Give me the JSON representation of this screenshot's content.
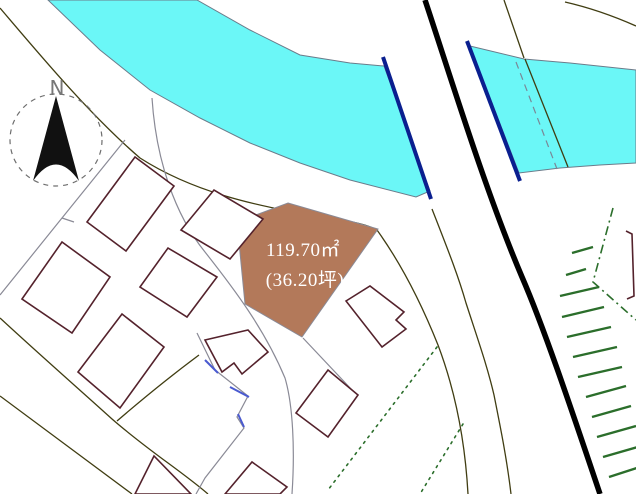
{
  "map": {
    "type": "cadastral-site-map",
    "compass": {
      "label": "N"
    },
    "parcel": {
      "area_label": "119.70㎡",
      "area_sub_label": "(36.20坪)"
    },
    "colors": {
      "river_fill": "#6bf7f7",
      "river_edge": "#6b7b8a",
      "river_inner_dash": "#7a8796",
      "river_bank_accent": "#0a1f8f",
      "parcel_fill": "#b3795a",
      "parcel_text": "#ffffff",
      "building_outline": "#54222c",
      "street_line": "#8a8a96",
      "contour_line": "#403d12",
      "highway_line": "#000000",
      "vegetation_green": "#2b6e2b",
      "waterline_blue": "#4a5ad0",
      "compass_ink": "#111111",
      "compass_ring": "#6e6e6e"
    }
  }
}
